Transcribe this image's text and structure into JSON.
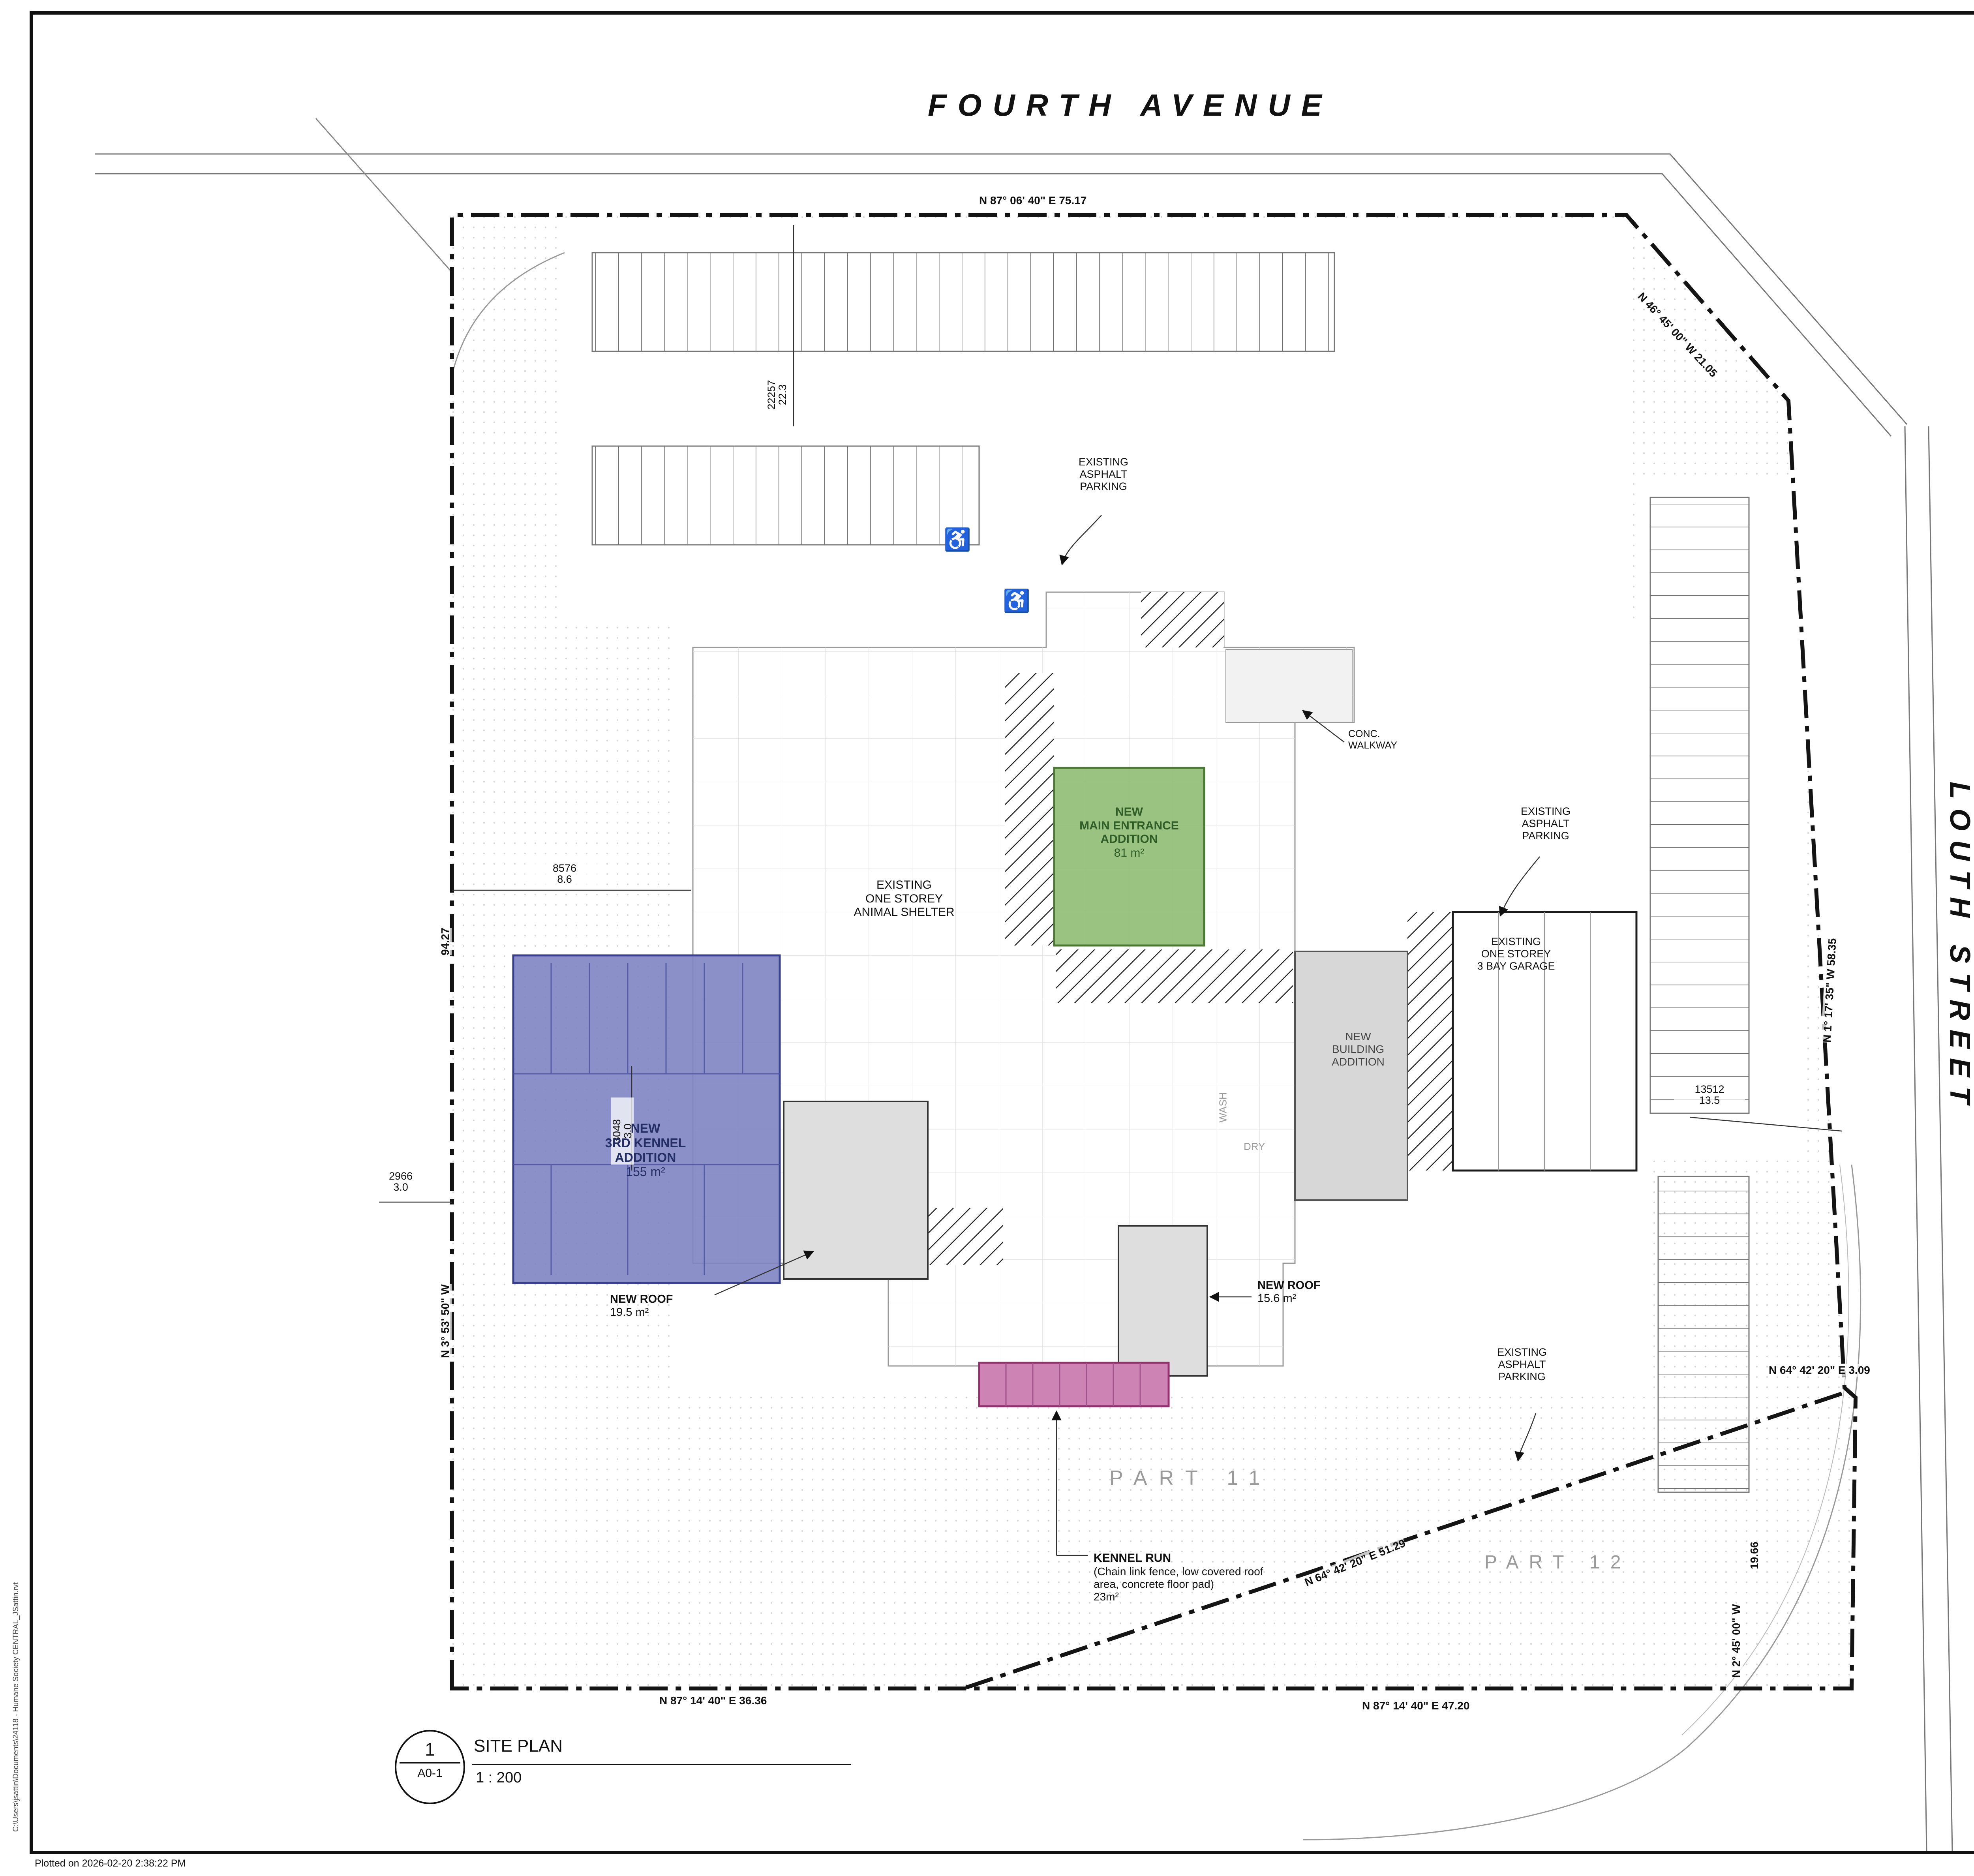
{
  "sheet": {
    "plotted_on": "Plotted on  2026-02-20 2:38:22 PM",
    "file_path": "C:\\Users\\jsattin\\Documents\\24118 - Humane Society CENTRAL_JSattin.rvt"
  },
  "site_plan": {
    "roads": {
      "fourth_avenue": "FOURTH AVENUE",
      "louth_street": "LOUTH STREET"
    },
    "bearings": {
      "top": "N 87° 06' 40\" E      75.17",
      "top_right_diag": "N 46° 45' 00\" W    21.05",
      "east": "N 1° 17' 35\" W     58.35",
      "jog": "N 64° 42' 20\" E    3.09",
      "east_len": "19.66",
      "east_lower": "N 2° 45' 00\" W",
      "diag": "N 64° 42' 20\" E    51.29",
      "bottom_left": "N 87° 14' 40\" E    36.36",
      "bottom_right": "N 87° 14' 40\" E    47.20",
      "west": "N 3° 53' 50\" W",
      "west_len": "94.27"
    },
    "dims": {
      "d22257": {
        "top": "22257",
        "bottom": "22.3"
      },
      "d8576": {
        "top": "8576",
        "bottom": "8.6"
      },
      "d3048": {
        "top": "3048",
        "bottom": "3.0"
      },
      "d2966": {
        "top": "2966",
        "bottom": "3.0"
      },
      "d13512": {
        "top": "13512",
        "bottom": "13.5"
      }
    },
    "labels": {
      "asphalt_top": "EXISTING\nASPHALT\nPARKING",
      "asphalt_right": "EXISTING\nASPHALT\nPARKING",
      "asphalt_bottom": "EXISTING\nASPHALT\nPARKING",
      "conc_walkway": "CONC.\nWALKWAY",
      "shelter": "EXISTING\nONE STOREY\nANIMAL SHELTER",
      "main_entrance": "NEW\nMAIN ENTRANCE\nADDITION",
      "main_entrance_area": "81 m²",
      "building_addition": "NEW\nBUILDING\nADDITION",
      "garage": "EXISTING\nONE STOREY\n3 BAY GARAGE",
      "kennel3": "NEW\n3RD KENNEL\nADDITION",
      "kennel3_area": "155 m²",
      "roof195": "NEW ROOF",
      "roof195_area": "19.5 m²",
      "roof156": "NEW ROOF",
      "roof156_area": "15.6 m²",
      "kennel_run": "KENNEL RUN",
      "kennel_run_desc": "(Chain link fence, low covered roof\narea, concrete floor pad)",
      "kennel_run_area": "23m²",
      "part11": "PART 11",
      "part12": "PART 12",
      "wash": "WASH",
      "dry": "DRY",
      "accessible_icon": "♿"
    },
    "viewport": {
      "number": "1",
      "sheet_ref": "A0-1",
      "title": "SITE PLAN",
      "scale": "1 : 200"
    }
  },
  "key_map": {
    "title": "KEY MAP",
    "fourth_ave": "FOURTH AVE.",
    "louth_st": "LOUTH ST.",
    "subject_1": "SUBJECT",
    "subject_2": "SITE"
  },
  "address": {
    "header": "ADDRESS",
    "civic_label": "CIVIC ADDRESS",
    "civic_value": "160 FOURTH AVENUE\nST. CATHARINES, ONTARIO\nL2S 0B6",
    "legal_label": "LEGAL DESCRIPTION",
    "legal_value_1": "PT LT 22 CON 6 GRANTHAM PT 11\n30R10217; T/W RO790345; ST. CATHARINES",
    "legal_value_2": "PT LT 22 CON 6 GRANTHAM PT 12\n30R10217; T/W RO774260, RO783931,\nRO790345; ST. CATHARINES"
  },
  "zoning_matrix": {
    "header": "ZONING MATRIX",
    "rows": [
      {
        "label": "ZONING DESIGNATION:",
        "value": "C4 - MAJOR COMMERCIAL"
      },
      {
        "label": "BYLAW NUMBER",
        "value": "2013-283"
      },
      {
        "label": "PERMITTED USES:",
        "value": "ANIMAL CARE ESTABLISHMENT"
      },
      {
        "label": "LOT AREA (MIN AND MAX)",
        "value": "8,153.12 m²  (0.815 Ha)"
      },
      {
        "label": "EXISTING BUILDING AREA",
        "value": "1,378.7 m²  (0.137 Ha) (16.9%)"
      },
      {
        "label": "PROPOSED NEW ADDITIONS",
        "value": "294.1 m²  (3.7%)"
      },
      {
        "label": "3RD KENNEL ADDITION",
        "value": "155.0 m²  (1.9%)"
      },
      {
        "label": "MAIN ENTRANCE ADDITION",
        "value": "81.0 m²  (1.0%)"
      },
      {
        "label": "NEW ROOFS",
        "value": "15.6 m² + 19.5 m² (0.5%)"
      },
      {
        "label": "OUTDOOR DOG RUN ACCESS",
        "value": "23.0 m²  (0.3%)"
      }
    ],
    "required_header": "REQUIRED:",
    "proposed_header": "PROPOSED:",
    "comparison_rows": [
      {
        "label": "FRONT YARD (MIN AND MAX)",
        "required": "3.0M AND 24.0M",
        "proposed": "22.3M"
      },
      {
        "label": "SIDE YARD EXTERIOR (MIN AND MAX)",
        "required": "3.0M AND 24.0M",
        "proposed": "13.5M"
      },
      {
        "label": "SIDE YARD REAR (MIN AND MAX)",
        "required": "-",
        "proposed": "22.2M"
      },
      {
        "label": "SIDE YARD INTERIOR (MIN AND MAX)",
        "required": "-",
        "proposed": "3.0M"
      },
      {
        "label": "BUILDING HEIGHT (MAX)",
        "required": "-",
        "proposed": "6.4M (21'-0\")"
      },
      {
        "label": "GROSS FLOOR AREA (MAX)\n(FOR PERMITTED COMMERCIAL USES)",
        "required": "-",
        "proposed": "-"
      },
      {
        "label": "LANDSCAPE AREA",
        "required": "-",
        "proposed": "4,282.87 M² (52.5%)"
      },
      {
        "label": "LOT COVERAGE",
        "required": "-",
        "proposed": "1,761.1 M² (21.6%)"
      },
      {
        "label": "LANDSCAPE BUFFER (MIN)",
        "required": "N/A",
        "proposed": "-"
      },
      {
        "label": "ACCESSIBLE PARKING (MIN)",
        "required": "2 STALLS",
        "proposed": "2 STALLS"
      }
    ]
  },
  "drawing_list": {
    "header": "DRAWING LIST",
    "items": [
      {
        "code": "A0-0",
        "title": "COVERSHEET"
      },
      {
        "code": "A1-0",
        "title": "SITE PLAN & STATISTICS"
      },
      {
        "code": "A1-1",
        "title": "BUILDING CODE MATRIX & CONTRUCTION ASSEMBLIES"
      },
      {
        "code": "A1-2",
        "title": "DOOR, WINDOW AND ROOM FINISH SCHEDULES"
      },
      {
        "code": "A1-3",
        "title": "DEMOLITION FLOOR PLAN"
      },
      {
        "code": "A1-4",
        "title": "FOUNDATION PLAN"
      },
      {
        "code": "A1-5",
        "title": "CONSTRUCTION PLAN"
      },
      {
        "code": "A1-6",
        "title": "REFLECTED CEILING PLAN"
      },
      {
        "code": "A1-7",
        "title": "ENLARGED FLOOR PLANS"
      },
      {
        "code": "A2-1",
        "title": "EXTERIOR ELEVATIONS"
      },
      {
        "code": "A2-2",
        "title": "BUILDING SECTIONS"
      },
      {
        "code": "A2-3",
        "title": "WALL SECTION DETAILS"
      }
    ]
  },
  "legend": {
    "title": "LEGEND - LEGAL NON CONFORMING USE",
    "items": [
      {
        "label": "KENNEL ADDITION",
        "color": "#2429d6"
      },
      {
        "label": "OUTDOOR AREA FOR DOG RUN",
        "color": "#d633b0"
      },
      {
        "label": "PROPOSED MAIN ENTRANCE",
        "color": "#3db53d"
      }
    ]
  },
  "title_block": {
    "north": "N",
    "issue_col": "Issue",
    "issued_for": "Issued for",
    "date_col": "Date",
    "init_col": "Init.",
    "seal": "Seal",
    "notes": [
      "Do not scale drawings. Report any discrepancies to Quartek Group Inc. before proceeding.",
      "Drawings must be sealed by the Architect and / or Engineer prior to the use for any building permit applications and / or government approval. Seals must be signed  by the Architect and / or Engineer before  drawings are used for any construction.",
      "All construction to be in accordance with the current Ontario Building Code and all applicable Ontario regulations.",
      "All drawings and related documents remain the property of Quartek Group Inc., all drawings are protected under copyright and under contract."
    ],
    "firm": {
      "name": "Quartek",
      "tags": [
        "Architects",
        "Planners",
        "Engineers",
        "Project Managers"
      ],
      "phone": "T  905 984 8676",
      "addr1": "89 - 91 St. Paul Street, Suite 100,",
      "addr2": "St. Catharines, ON, L2R 3M3",
      "web": "www.quartekgroup.com",
      "accent": "#c0272d"
    },
    "project_title_label": "Project Title",
    "project_name": "HUMANE SOCIETY OF\nGREATER NIAGARA",
    "project_addr": "160 FOURTH AVE,\nST. CATHARINES, ON L2S 0B6",
    "drawing_title_label": "Drawing Title",
    "drawing_title": "SITE PLAN",
    "drawn_label": "Drawn",
    "drawn": "JS",
    "designed_label": "Designed by",
    "designed": "MG",
    "scale_label": "Scale",
    "scale": "As indicated",
    "date_label": "Date Created",
    "date": "03JAN2025",
    "job_label": "Job Number",
    "job": "24118",
    "issue_label": "Issue",
    "issue": "",
    "dwg_num_label": "Drawing Number",
    "dwg_num": "A0-1"
  }
}
